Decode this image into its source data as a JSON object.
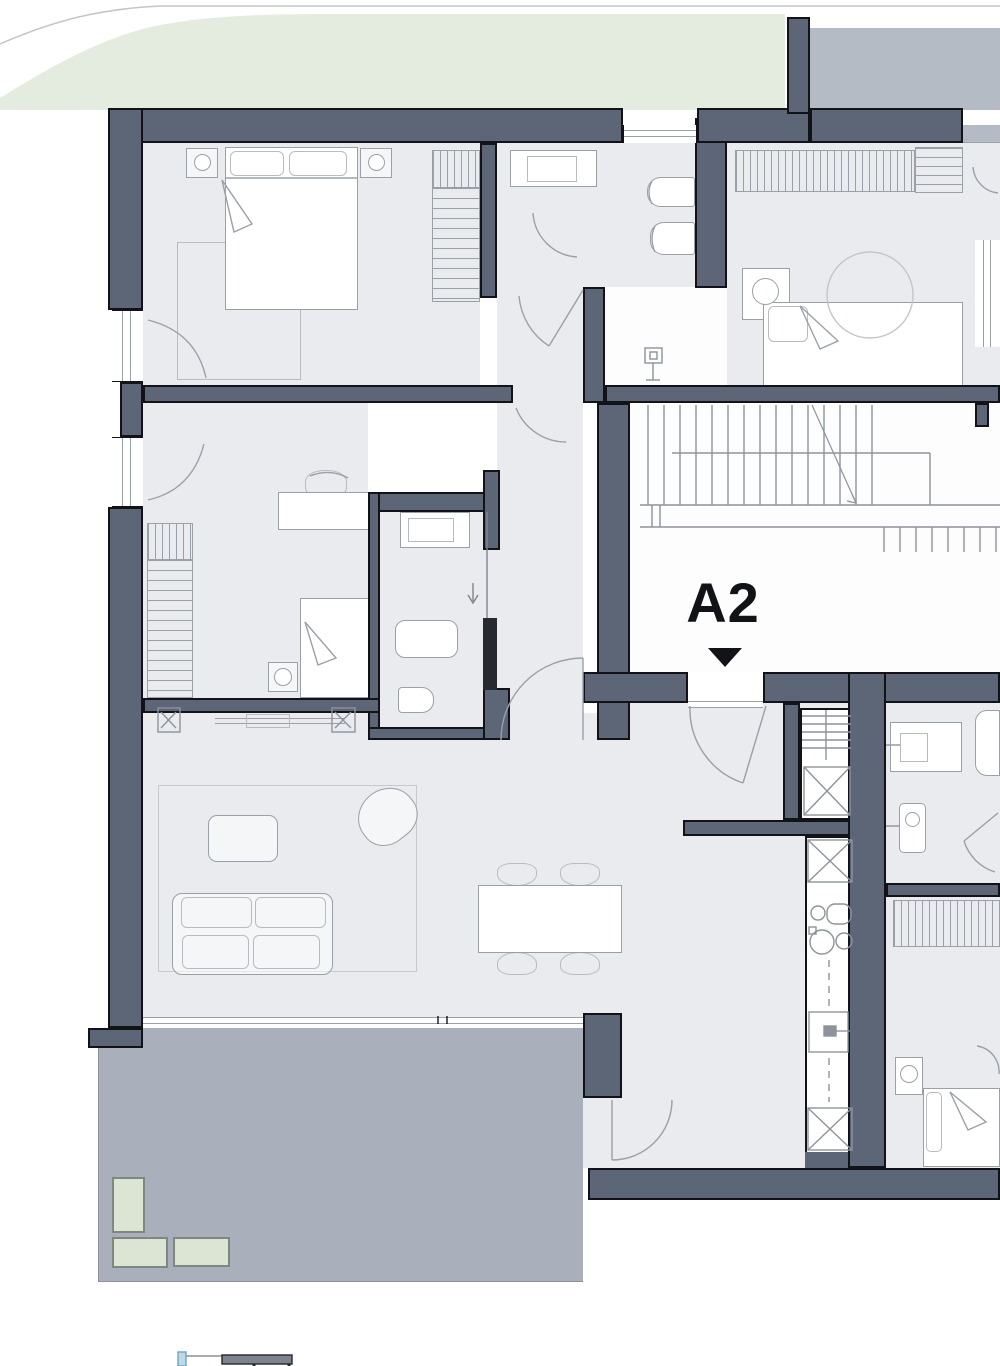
{
  "plan": {
    "unit_label": "A2",
    "entrance_marker": "down-triangle"
  },
  "colors": {
    "wall": "#5c6677",
    "floor": "#e9ebee",
    "terrace": "#a9b0bc",
    "green": "#e4ecdf",
    "band": "#b4bbc4",
    "line": "#9aa0a8",
    "ink": "#111317",
    "planter": "#dce5d3",
    "white": "#fdfdfe"
  },
  "icons": [
    "double-bed-icon",
    "single-bed-icon",
    "nightstand-lamp-icon",
    "wardrobe-icon",
    "desk-chair-icon",
    "speaker-icon",
    "sofa-icon",
    "armchair-icon",
    "coffee-table-icon",
    "dining-table-icon",
    "dining-chair-icon",
    "sideboard-icon",
    "plant-icon",
    "sink-icon",
    "toilet-icon",
    "bidet-icon",
    "bathtub-icon",
    "shower-arrow-icon",
    "washing-machine-icon",
    "kitchen-hob-icon",
    "kitchen-sink-icon",
    "oven-icon",
    "tall-cabinet-x-icon",
    "stairs-icon",
    "door-swing-icon",
    "window-icon",
    "planter-box-icon",
    "standpipe-icon"
  ]
}
